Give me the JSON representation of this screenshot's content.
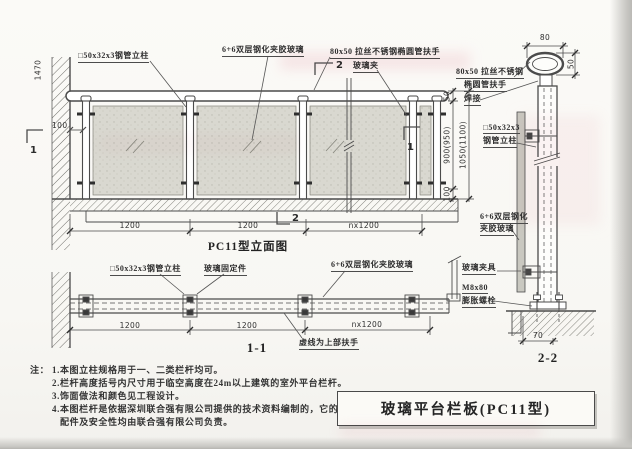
{
  "sheet": {
    "kind": "architectural detail drawing",
    "ink_color": "#4b4b4b",
    "glass_color": "#d9d8d0",
    "bleed_color": "#eeb7c4"
  },
  "elevation": {
    "title": "PC11型立面图",
    "label_post": "□50x32x3钢管立柱",
    "label_glass": "6+6双层钢化夹胶玻璃",
    "label_handrail": "80x50 拉丝不锈钢椭圆管扶手",
    "label_clamp": "玻璃夹",
    "marker_top": "2",
    "marker_bottom": "2",
    "marker_left": "1",
    "marker_right": "1",
    "dim_side": "1470",
    "dim_offset": "100",
    "dim_bay1": "1200",
    "dim_bay2": "1200",
    "dim_bayn": "nx1200",
    "dim_rail": "50",
    "dim_glass_h": "900(950)",
    "dim_base": "100",
    "dim_total": "1050(1100)"
  },
  "section11": {
    "title": "1-1",
    "label_post": "□50x32x3钢管立柱",
    "label_fixing": "玻璃固定件",
    "label_glass": "6+6双层钢化夹胶玻璃",
    "note_dashed": "虚线为上部扶手",
    "dim_bay1": "1200",
    "dim_bay2": "1200",
    "dim_bayn": "nx1200"
  },
  "detail22": {
    "title": "2-2",
    "dim_width": "80",
    "dim_height": "50",
    "dim_base": "70",
    "label_rail1": "80x50 拉丝不锈钢",
    "label_rail2": "椭圆管扶手",
    "label_weld": "焊接",
    "label_post1": "□50x32x3",
    "label_post2": "钢管立柱",
    "label_glass1": "6+6双层钢化",
    "label_glass2": "夹胶玻璃",
    "label_clamp": "玻璃夹具",
    "label_bolt1": "M8x80",
    "label_bolt2": "膨胀螺栓"
  },
  "notes": {
    "prefix": "注：",
    "items": [
      "1.本图立柱规格用于一、二类栏杆均可。",
      "2.栏杆高度括号内尺寸用于临空高度在24m以上建筑的室外平台栏杆。",
      "3.饰面做法和颜色见工程设计。",
      "4.本图栏杆是依据深圳联合强有限公司提供的技术资料编制的，它的",
      "配件及安全性均由联合强有限公司负责。"
    ]
  },
  "title_block": {
    "title": "玻璃平台栏板(PC11型)"
  }
}
